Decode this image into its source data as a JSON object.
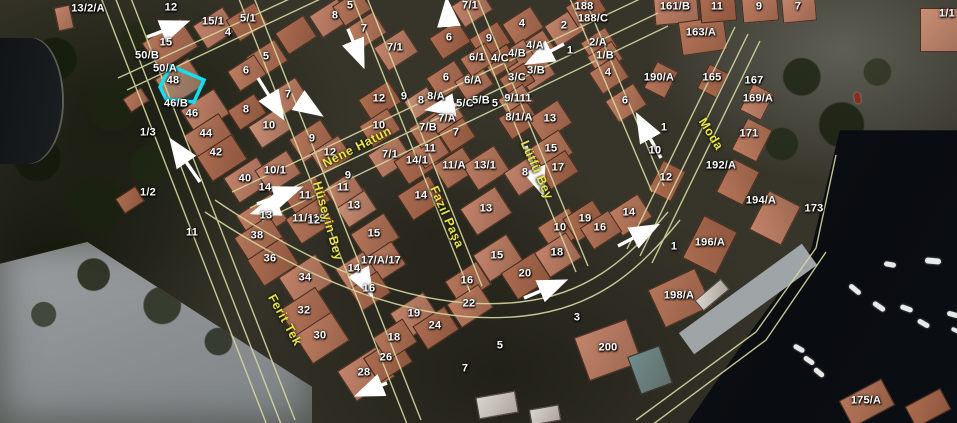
{
  "map": {
    "type": "aerial-cadastral-map",
    "colors": {
      "parcel_line": "#d6d7a0",
      "label_text": "#ffffff",
      "street_text": "#e9e448",
      "highlight": "#12dff2",
      "arrow": "#ffffff"
    },
    "highlighted_parcel": {
      "points": [
        [
          160,
          87
        ],
        [
          171,
          66
        ],
        [
          204,
          80
        ],
        [
          194,
          102
        ],
        [
          166,
          99
        ]
      ]
    },
    "street_labels": [
      {
        "text": "Nene Hatun",
        "x": 357,
        "y": 147,
        "rot": -27
      },
      {
        "text": "Hüseyin Bey",
        "x": 328,
        "y": 221,
        "rot": 74
      },
      {
        "text": "Fazıl Paşa",
        "x": 447,
        "y": 217,
        "rot": 66
      },
      {
        "text": "Ferit Tek",
        "x": 285,
        "y": 320,
        "rot": 61
      },
      {
        "text": "Lütfü Bey",
        "x": 537,
        "y": 170,
        "rot": 66
      },
      {
        "text": "Moda",
        "x": 711,
        "y": 134,
        "rot": 58
      }
    ],
    "parcel_labels": [
      {
        "text": "13/2/A",
        "x": 88,
        "y": 9
      },
      {
        "text": "12",
        "x": 171,
        "y": 8
      },
      {
        "text": "15/1",
        "x": 213,
        "y": 22
      },
      {
        "text": "4",
        "x": 228,
        "y": 33
      },
      {
        "text": "15",
        "x": 166,
        "y": 43
      },
      {
        "text": "50/B",
        "x": 147,
        "y": 56
      },
      {
        "text": "50/A",
        "x": 165,
        "y": 69
      },
      {
        "text": "48",
        "x": 173,
        "y": 81
      },
      {
        "text": "46/B",
        "x": 176,
        "y": 104
      },
      {
        "text": "46",
        "x": 192,
        "y": 114
      },
      {
        "text": "1/3",
        "x": 148,
        "y": 133
      },
      {
        "text": "44",
        "x": 206,
        "y": 134
      },
      {
        "text": "42",
        "x": 216,
        "y": 153
      },
      {
        "text": "40",
        "x": 245,
        "y": 179
      },
      {
        "text": "14",
        "x": 265,
        "y": 188
      },
      {
        "text": "10/1",
        "x": 275,
        "y": 171
      },
      {
        "text": "1/2",
        "x": 148,
        "y": 193
      },
      {
        "text": "11",
        "x": 192,
        "y": 233
      },
      {
        "text": "38",
        "x": 257,
        "y": 236
      },
      {
        "text": "36",
        "x": 270,
        "y": 259
      },
      {
        "text": "34",
        "x": 305,
        "y": 278
      },
      {
        "text": "32",
        "x": 304,
        "y": 311
      },
      {
        "text": "30",
        "x": 320,
        "y": 336
      },
      {
        "text": "28",
        "x": 364,
        "y": 373
      },
      {
        "text": "26",
        "x": 386,
        "y": 358
      },
      {
        "text": "13",
        "x": 266,
        "y": 216
      },
      {
        "text": "11/112",
        "x": 309,
        "y": 219
      },
      {
        "text": "11",
        "x": 305,
        "y": 196
      },
      {
        "text": "8",
        "x": 246,
        "y": 110
      },
      {
        "text": "10",
        "x": 269,
        "y": 126
      },
      {
        "text": "9",
        "x": 312,
        "y": 139
      },
      {
        "text": "12",
        "x": 330,
        "y": 153
      },
      {
        "text": "5/1",
        "x": 248,
        "y": 19
      },
      {
        "text": "5",
        "x": 266,
        "y": 57
      },
      {
        "text": "6",
        "x": 246,
        "y": 71
      },
      {
        "text": "7",
        "x": 288,
        "y": 95
      },
      {
        "text": "5",
        "x": 350,
        "y": 6
      },
      {
        "text": "8",
        "x": 335,
        "y": 16
      },
      {
        "text": "7",
        "x": 364,
        "y": 29
      },
      {
        "text": "7/1",
        "x": 395,
        "y": 48
      },
      {
        "text": "6",
        "x": 449,
        "y": 38
      },
      {
        "text": "6",
        "x": 446,
        "y": 78
      },
      {
        "text": "6/A",
        "x": 473,
        "y": 81
      },
      {
        "text": "12",
        "x": 379,
        "y": 99
      },
      {
        "text": "9",
        "x": 404,
        "y": 97
      },
      {
        "text": "8",
        "x": 421,
        "y": 101
      },
      {
        "text": "8/A",
        "x": 436,
        "y": 97
      },
      {
        "text": "7/1",
        "x": 470,
        "y": 6
      },
      {
        "text": "9",
        "x": 489,
        "y": 39
      },
      {
        "text": "4",
        "x": 522,
        "y": 24
      },
      {
        "text": "2",
        "x": 564,
        "y": 26
      },
      {
        "text": "188",
        "x": 584,
        "y": 7
      },
      {
        "text": "188/C",
        "x": 593,
        "y": 19
      },
      {
        "text": "4/A",
        "x": 535,
        "y": 46
      },
      {
        "text": "1",
        "x": 570,
        "y": 51
      },
      {
        "text": "2/A",
        "x": 598,
        "y": 43
      },
      {
        "text": "1/B",
        "x": 605,
        "y": 56
      },
      {
        "text": "4/B",
        "x": 517,
        "y": 54
      },
      {
        "text": "4/C",
        "x": 500,
        "y": 59
      },
      {
        "text": "6/1",
        "x": 477,
        "y": 58
      },
      {
        "text": "3/B",
        "x": 536,
        "y": 71
      },
      {
        "text": "3/C",
        "x": 517,
        "y": 78
      },
      {
        "text": "4",
        "x": 608,
        "y": 73
      },
      {
        "text": "6",
        "x": 625,
        "y": 101
      },
      {
        "text": "5/C",
        "x": 465,
        "y": 104
      },
      {
        "text": "5/B",
        "x": 481,
        "y": 101
      },
      {
        "text": "5",
        "x": 495,
        "y": 104
      },
      {
        "text": "9/111",
        "x": 518,
        "y": 99
      },
      {
        "text": "8/1/A",
        "x": 519,
        "y": 118
      },
      {
        "text": "13",
        "x": 550,
        "y": 119
      },
      {
        "text": "10",
        "x": 379,
        "y": 126
      },
      {
        "text": "7/B",
        "x": 428,
        "y": 128
      },
      {
        "text": "7/A",
        "x": 447,
        "y": 119
      },
      {
        "text": "7",
        "x": 456,
        "y": 133
      },
      {
        "text": "11",
        "x": 430,
        "y": 149
      },
      {
        "text": "14/1",
        "x": 417,
        "y": 161
      },
      {
        "text": "7/1",
        "x": 390,
        "y": 155
      },
      {
        "text": "11/A",
        "x": 454,
        "y": 166
      },
      {
        "text": "13/1",
        "x": 485,
        "y": 166
      },
      {
        "text": "15",
        "x": 551,
        "y": 149
      },
      {
        "text": "17",
        "x": 558,
        "y": 168
      },
      {
        "text": "8",
        "x": 525,
        "y": 173
      },
      {
        "text": "9",
        "x": 348,
        "y": 176
      },
      {
        "text": "11",
        "x": 343,
        "y": 188
      },
      {
        "text": "13",
        "x": 354,
        "y": 206
      },
      {
        "text": "12",
        "x": 314,
        "y": 221
      },
      {
        "text": "15",
        "x": 374,
        "y": 234
      },
      {
        "text": "14",
        "x": 421,
        "y": 196
      },
      {
        "text": "13",
        "x": 486,
        "y": 209
      },
      {
        "text": "10",
        "x": 560,
        "y": 228
      },
      {
        "text": "18",
        "x": 557,
        "y": 253
      },
      {
        "text": "19",
        "x": 585,
        "y": 219
      },
      {
        "text": "14",
        "x": 629,
        "y": 213
      },
      {
        "text": "16",
        "x": 600,
        "y": 228
      },
      {
        "text": "12",
        "x": 666,
        "y": 178
      },
      {
        "text": "1",
        "x": 664,
        "y": 128
      },
      {
        "text": "10",
        "x": 655,
        "y": 151
      },
      {
        "text": "161/B",
        "x": 675,
        "y": 7
      },
      {
        "text": "11",
        "x": 717,
        "y": 7
      },
      {
        "text": "9",
        "x": 759,
        "y": 7
      },
      {
        "text": "7",
        "x": 798,
        "y": 7
      },
      {
        "text": "1/1",
        "x": 947,
        "y": 14
      },
      {
        "text": "163/A",
        "x": 701,
        "y": 33
      },
      {
        "text": "190/A",
        "x": 659,
        "y": 78
      },
      {
        "text": "165",
        "x": 712,
        "y": 78
      },
      {
        "text": "167",
        "x": 754,
        "y": 81
      },
      {
        "text": "169/A",
        "x": 758,
        "y": 99
      },
      {
        "text": "171",
        "x": 749,
        "y": 134
      },
      {
        "text": "192/A",
        "x": 721,
        "y": 166
      },
      {
        "text": "194/A",
        "x": 761,
        "y": 201
      },
      {
        "text": "173",
        "x": 814,
        "y": 209
      },
      {
        "text": "196/A",
        "x": 710,
        "y": 243
      },
      {
        "text": "1",
        "x": 674,
        "y": 247
      },
      {
        "text": "17/A/17",
        "x": 381,
        "y": 261
      },
      {
        "text": "14",
        "x": 354,
        "y": 269
      },
      {
        "text": "16",
        "x": 369,
        "y": 289
      },
      {
        "text": "15",
        "x": 497,
        "y": 256
      },
      {
        "text": "20",
        "x": 525,
        "y": 274
      },
      {
        "text": "18",
        "x": 557,
        "y": 253
      },
      {
        "text": "16",
        "x": 467,
        "y": 281
      },
      {
        "text": "22",
        "x": 469,
        "y": 304
      },
      {
        "text": "19",
        "x": 414,
        "y": 314
      },
      {
        "text": "24",
        "x": 435,
        "y": 326
      },
      {
        "text": "18",
        "x": 394,
        "y": 338
      },
      {
        "text": "3",
        "x": 577,
        "y": 318
      },
      {
        "text": "5",
        "x": 500,
        "y": 346
      },
      {
        "text": "7",
        "x": 465,
        "y": 369
      },
      {
        "text": "200",
        "x": 608,
        "y": 348
      },
      {
        "text": "198/A",
        "x": 679,
        "y": 296
      },
      {
        "text": "175/A",
        "x": 866,
        "y": 401
      }
    ],
    "arrows": [
      {
        "x1": 147,
        "y1": 37,
        "x2": 184,
        "y2": 23
      },
      {
        "x1": 348,
        "y1": 29,
        "x2": 362,
        "y2": 63
      },
      {
        "x1": 258,
        "y1": 78,
        "x2": 281,
        "y2": 115
      },
      {
        "x1": 301,
        "y1": 102,
        "x2": 318,
        "y2": 113
      },
      {
        "x1": 449,
        "y1": 27,
        "x2": 447,
        "y2": 3
      },
      {
        "x1": 564,
        "y1": 44,
        "x2": 530,
        "y2": 62
      },
      {
        "x1": 460,
        "y1": 104,
        "x2": 431,
        "y2": 109
      },
      {
        "x1": 200,
        "y1": 182,
        "x2": 173,
        "y2": 143
      },
      {
        "x1": 257,
        "y1": 204,
        "x2": 297,
        "y2": 189
      },
      {
        "x1": 277,
        "y1": 205,
        "x2": 256,
        "y2": 212
      },
      {
        "x1": 355,
        "y1": 265,
        "x2": 370,
        "y2": 292
      },
      {
        "x1": 387,
        "y1": 383,
        "x2": 360,
        "y2": 394
      },
      {
        "x1": 524,
        "y1": 298,
        "x2": 562,
        "y2": 282
      },
      {
        "x1": 618,
        "y1": 246,
        "x2": 654,
        "y2": 227
      },
      {
        "x1": 661,
        "y1": 158,
        "x2": 639,
        "y2": 118
      },
      {
        "x1": 526,
        "y1": 146,
        "x2": 542,
        "y2": 191
      }
    ]
  }
}
